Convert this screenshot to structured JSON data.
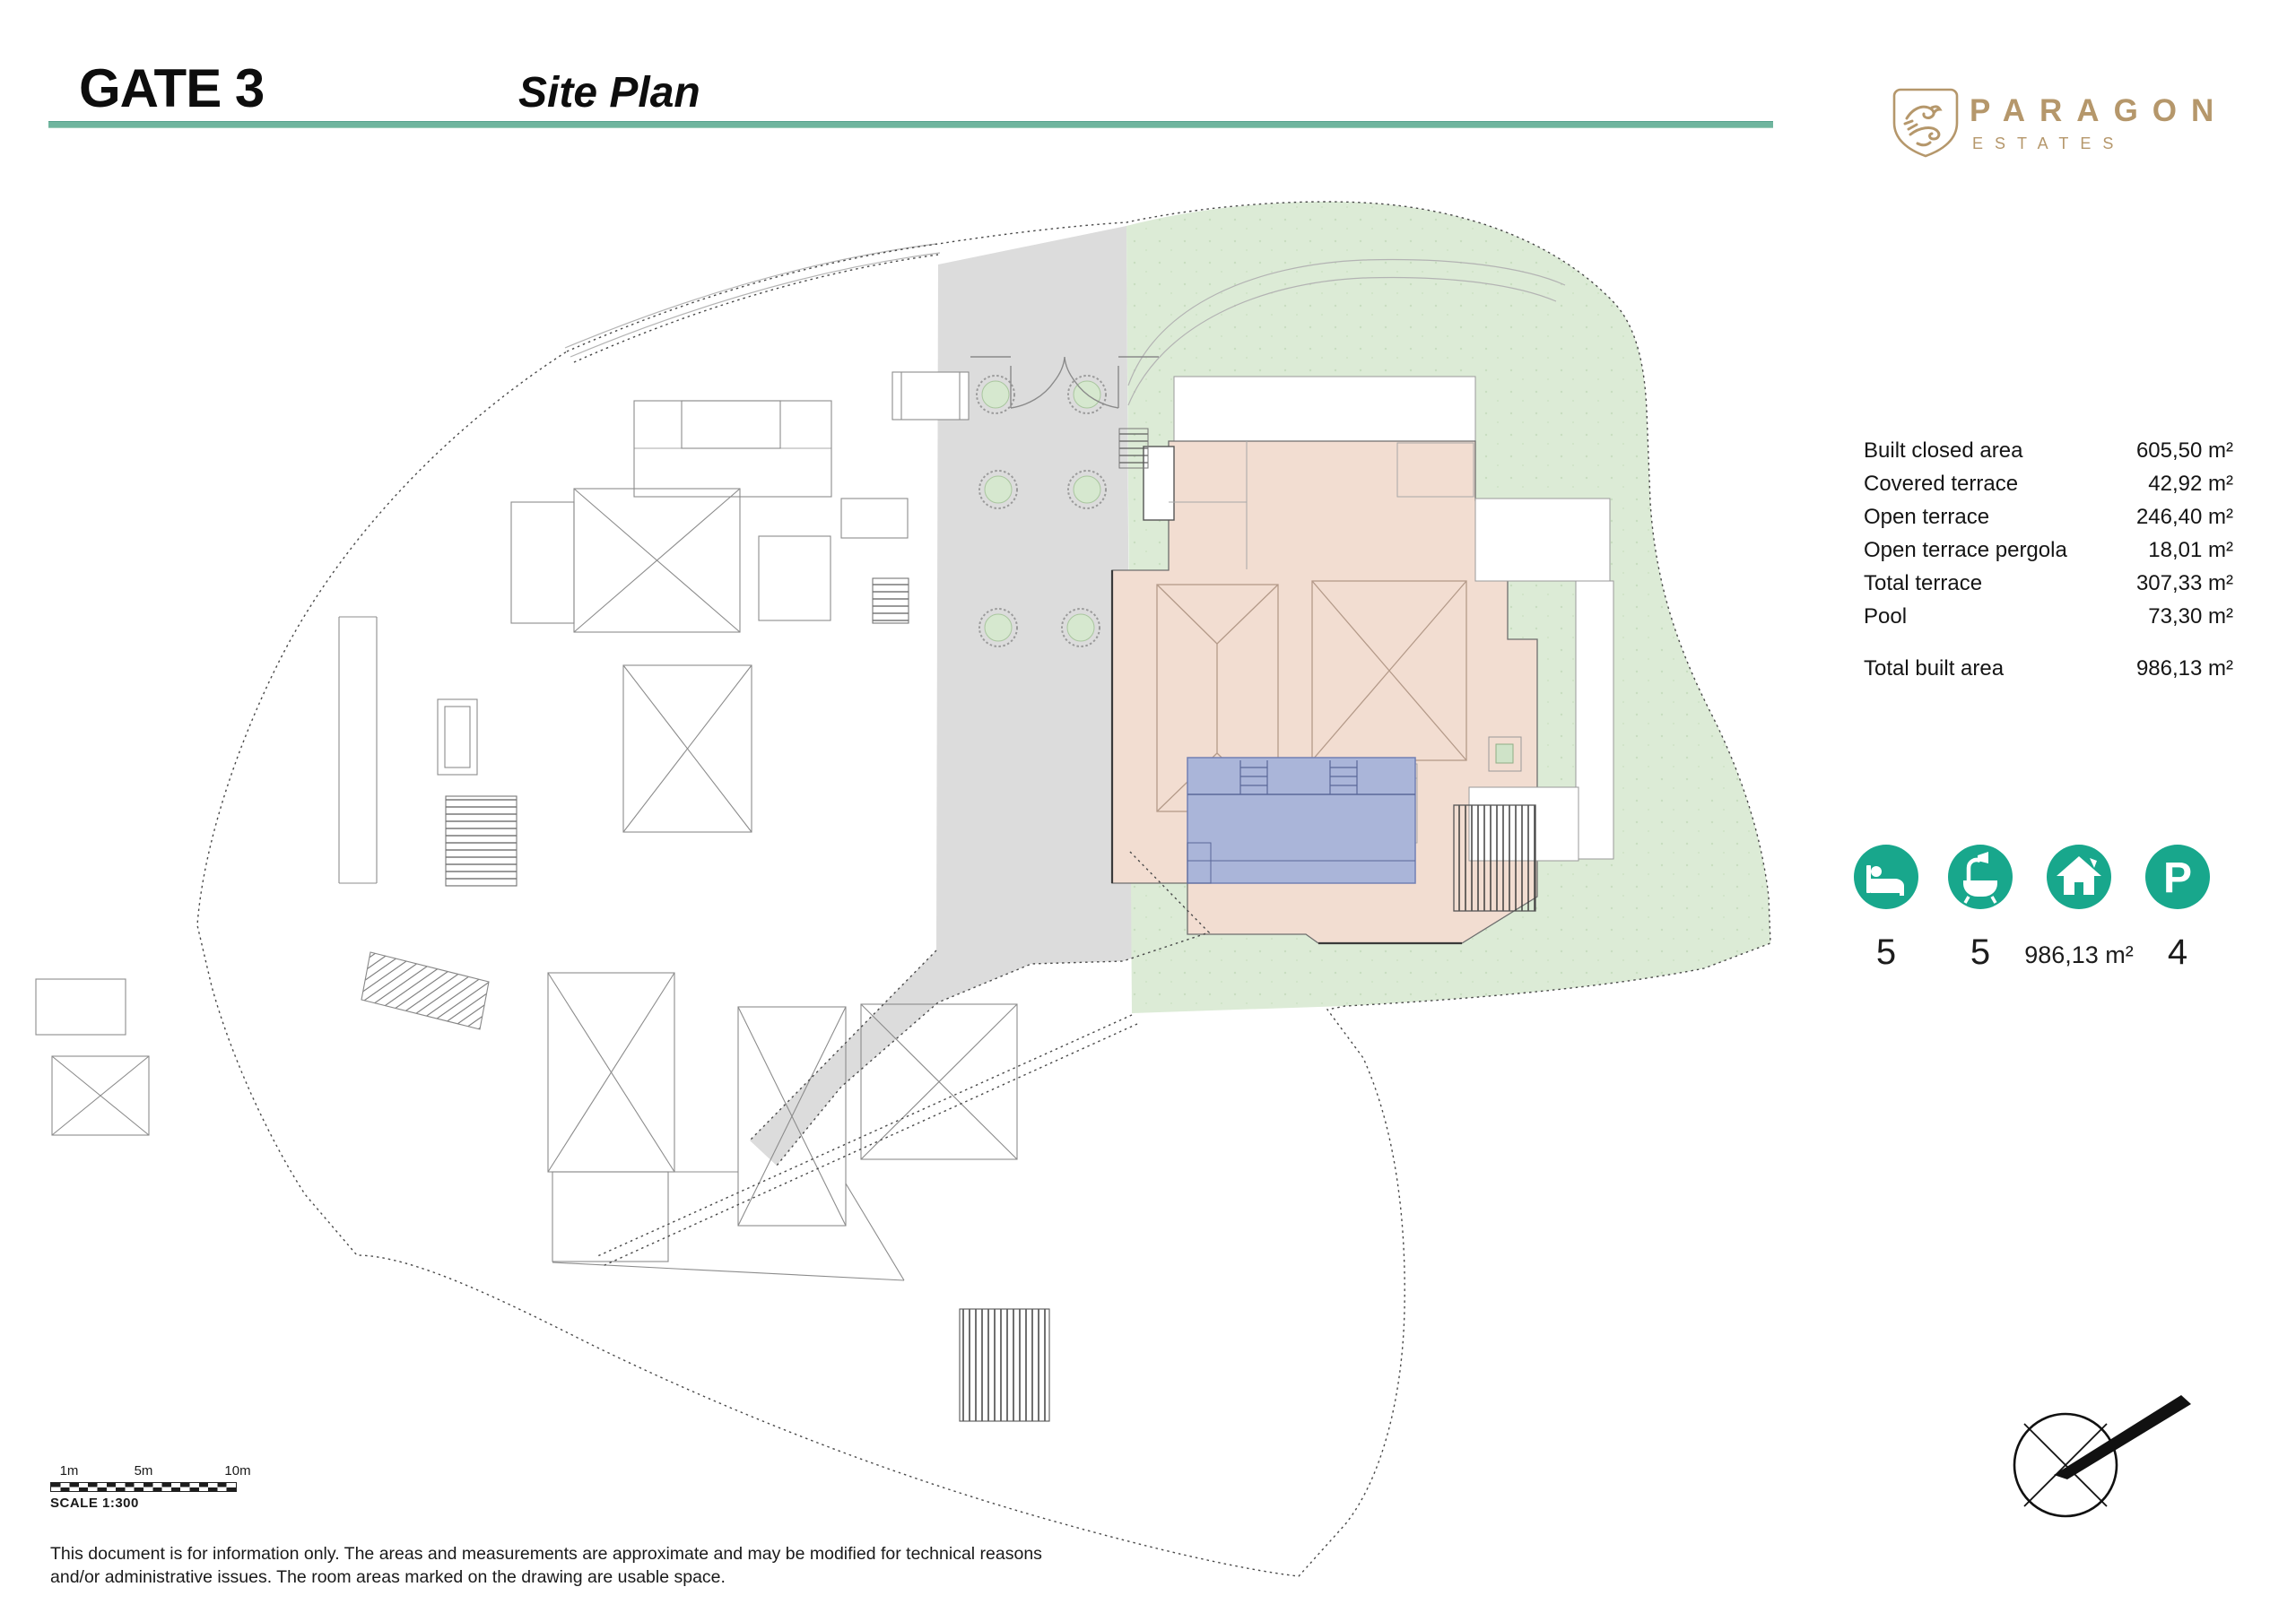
{
  "page": {
    "title": "GATE 3",
    "subtitle": "Site Plan"
  },
  "brand": {
    "name": "PARAGON",
    "tagline": "ESTATES"
  },
  "area_table": {
    "rows": [
      {
        "label": "Built closed area",
        "value": "605,50 m²"
      },
      {
        "label": "Covered terrace",
        "value": "42,92 m²"
      },
      {
        "label": "Open terrace",
        "value": "246,40 m²"
      },
      {
        "label": "Open terrace pergola",
        "value": "18,01 m²"
      },
      {
        "label": "Total terrace",
        "value": "307,33 m²"
      },
      {
        "label": "Pool",
        "value": "73,30 m²"
      }
    ],
    "total_row": {
      "label": "Total built area",
      "value": "986,13 m²"
    }
  },
  "features": {
    "bedrooms": "5",
    "bathrooms": "5",
    "built_area": "986,13 m²",
    "parking": "4",
    "parking_icon_letter": "P"
  },
  "scale_bar": {
    "tick_1": "1m",
    "tick_2": "5m",
    "tick_3": "10m",
    "label": "SCALE 1:300"
  },
  "disclaimer": {
    "line1": "This document is for information only. The areas and measurements are approximate and may be modified for technical reasons",
    "line2": "and/or administrative issues. The room areas marked on the drawing are usable space."
  },
  "colors": {
    "accent_teal": "#18A78C",
    "header_rule": "#6FB59E",
    "brand_gold": "#B5976B",
    "villa_fill": "#F2DDD1",
    "pool_fill": "#AAB5D9",
    "garden_fill": "#DCEBD6",
    "driveway_fill": "#DCDCDC"
  }
}
